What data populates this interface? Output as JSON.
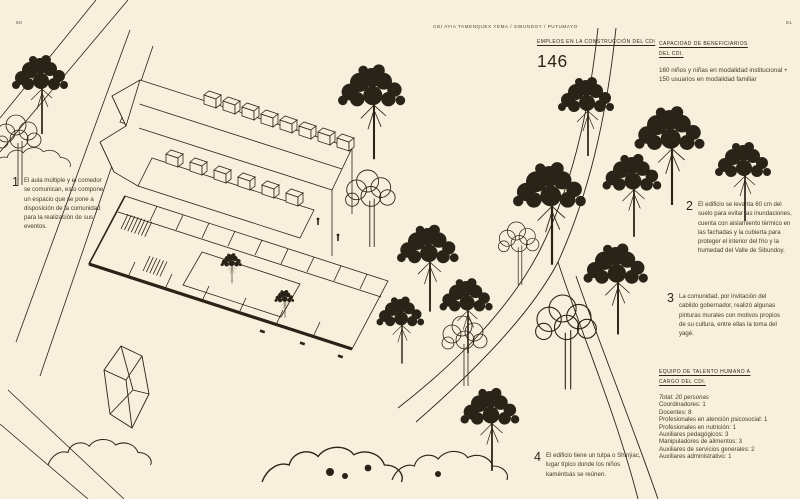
{
  "page": {
    "left_number": "60",
    "right_number": "61",
    "header": "CDI AYIA TAMENQUEX YEMA / SIBUNDOY / PUTUMAYO"
  },
  "stats": {
    "jobs": {
      "title": "EMPLEOS EN LA CONSTRUCCIÓN DEL CDI",
      "value": "146"
    },
    "capacity": {
      "title": "CAPACIDAD DE BENEFICIARIOS DEL CDI.",
      "body": "160 niños y niñas en modalidad institucional + 150 usuarios en modalidad familiar"
    }
  },
  "annotations": [
    {
      "num": "1",
      "text": "El aula múltiple y el comedor se comunican, esto compone un espacio que se pone a disposición de la comunidad para la realización de sus eventos."
    },
    {
      "num": "2",
      "text": "El edificio se levanta 60 cm del suelo para evitar las inundaciones, cuenta con aislamiento térmico en las fachadas y la cubierta para proteger el interior del frío y la humedad del Valle de Sibundoy."
    },
    {
      "num": "3",
      "text": "La comunidad, por invitación del cabildo gobernador, realizó algunas pinturas murales con motivos propios de su cultura, entre ellas la toma del yagé."
    },
    {
      "num": "4",
      "text": "El edificio tiene un tulpa o Shinÿac, lugar típico donde los niños kaméntsás se reúnen."
    }
  ],
  "team": {
    "title": "EQUIPO DE TALENTO HUMANO A CARGO DEL CDI.",
    "total": "Total: 20 personas",
    "items": [
      "Coordinadores: 1",
      "Docentes: 8",
      "Profesionales en atención psicosocial: 1",
      "Profesionales en nutrición: 1",
      "Auxiliares pedagógicos: 3",
      "Manipuladores de alimentos: 3",
      "Auxiliares de servicios generales: 2",
      "Auxiliares administrativo: 1"
    ]
  },
  "colors": {
    "background": "#f8f0dc",
    "ink": "#2a2318"
  }
}
